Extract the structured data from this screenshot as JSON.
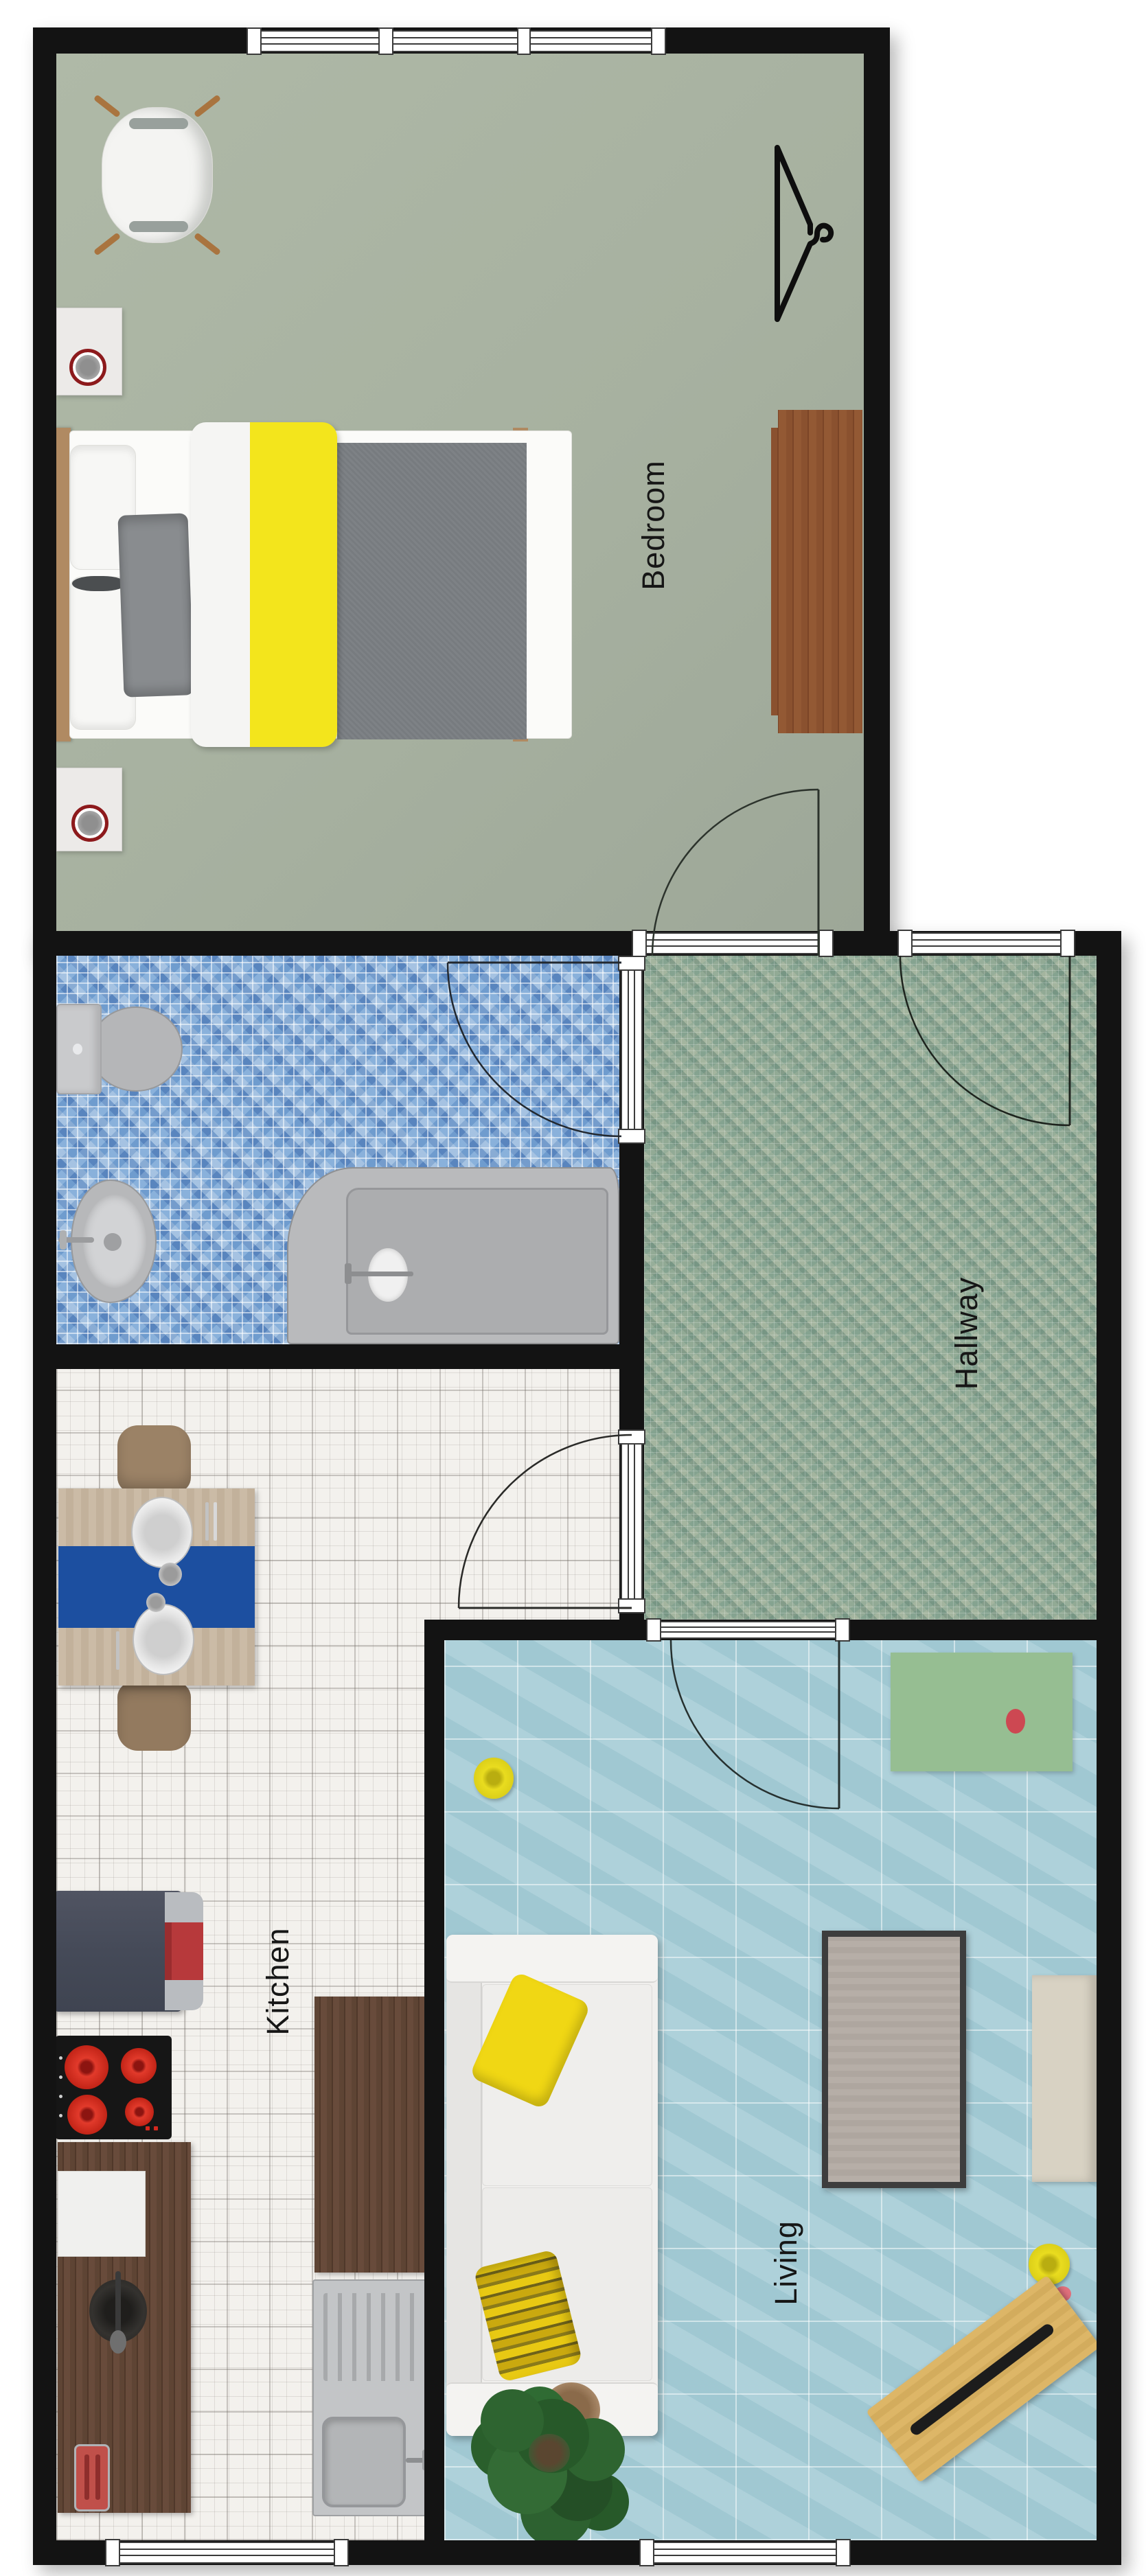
{
  "plan": {
    "title": "Apartment floor plan",
    "rooms": [
      {
        "id": "bedroom",
        "label": "Bedroom"
      },
      {
        "id": "hallway",
        "label": "Hallway"
      },
      {
        "id": "kitchen",
        "label": "Kitchen"
      },
      {
        "id": "living",
        "label": "Living"
      },
      {
        "id": "bathroom",
        "label": ""
      }
    ],
    "colors": {
      "wall": "#131313",
      "bedroom_floor": "#a9b3a1",
      "bathroom_floor_mosaic_blue": "#7ea6d2",
      "hallway_floor_mosaic_green": "#90a794",
      "kitchen_floor_tile_white": "#f3f1ed",
      "living_floor_tile_teal": "#a7cdd7",
      "accent_yellow": "#f3e51c",
      "runner_blue": "#1c4fa0",
      "sideboard_green": "#96be92",
      "wood_counter": "#5e4434",
      "wood_dresser": "#8a512f",
      "wood_table": "#c8b8a2",
      "sofa_white": "#f0efed",
      "blanket_gray": "#7e8286",
      "burner_red": "#d5281e",
      "lamp_ring_red": "#8d1a1c"
    },
    "furniture": [
      "armchair",
      "double-bed",
      "nightstand-with-lamp",
      "nightstand-with-lamp",
      "dresser",
      "clothes-hanger-symbol",
      "toilet",
      "bidet",
      "bathtub",
      "dining-table-with-runner-and-plates",
      "dining-chair",
      "dining-chair",
      "refrigerator",
      "cooktop",
      "counter-with-cutting-board",
      "kitchen-island",
      "sink-unit",
      "toaster",
      "bowl",
      "sofa-with-yellow-pillows",
      "coffee-table",
      "tv-bench",
      "green-sideboard",
      "yellow-pouf",
      "yellow-pouf",
      "potted-plant",
      "wooden-bench-with-remote"
    ],
    "doors": [
      "bedroom-door",
      "bathroom-door",
      "entrance-door",
      "kitchen-door",
      "living-door"
    ],
    "windows": [
      "bedroom-window-triple",
      "kitchen-window",
      "living-window"
    ]
  }
}
